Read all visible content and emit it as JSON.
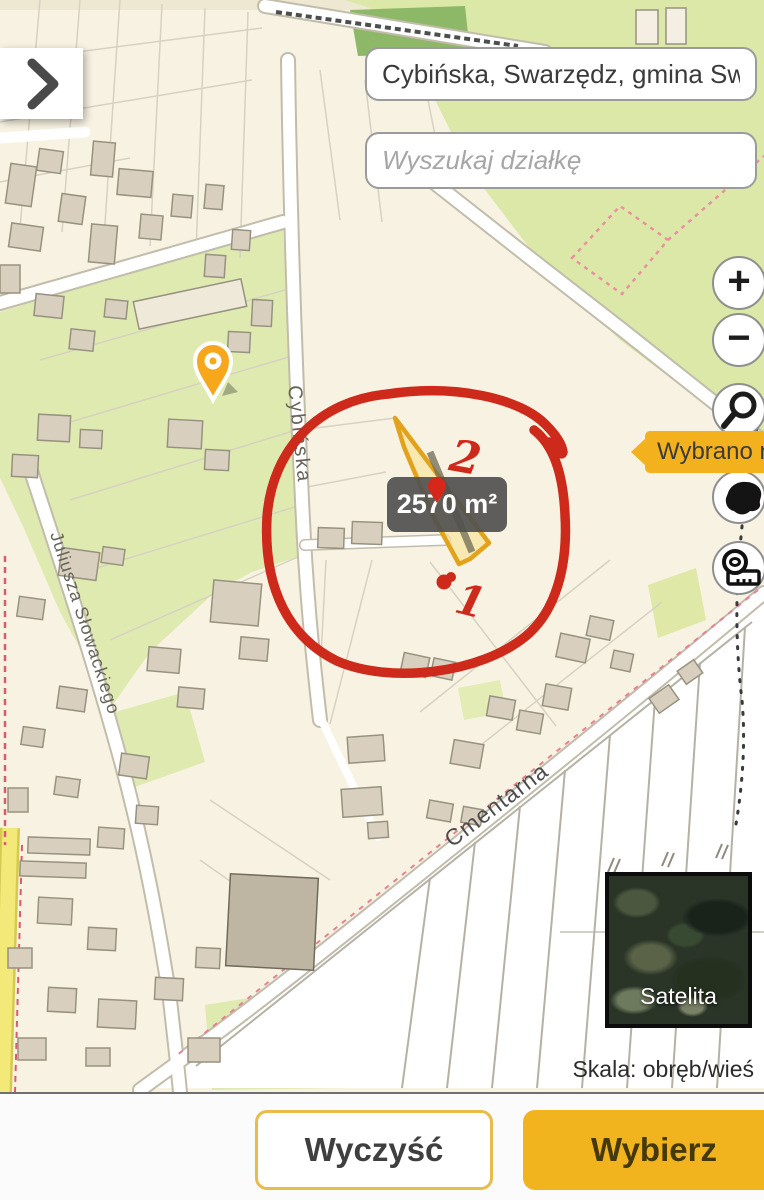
{
  "search": {
    "location_value": "Cybińska, Swarzędz, gmina Swa",
    "parcel_placeholder": "Wyszukaj działkę"
  },
  "controls": {
    "zoom_in": "+",
    "zoom_out": "−",
    "search_tool_icon": "magnifier-icon",
    "region_tool_icon": "poland-outline-icon",
    "measure_tool_icon": "tape-measure-icon"
  },
  "notification": {
    "text": "Wybrano ni"
  },
  "map": {
    "area_tooltip": "2570 m²",
    "streets": {
      "cybinska": "Cybińska",
      "slowackiego": "Juliusza Słowackiego",
      "cmentarna": "Cmentarna"
    },
    "annotations": {
      "one": "1",
      "two": "2"
    }
  },
  "layers": {
    "satellite_label": "Satelita"
  },
  "scale": {
    "label": "Skala: obręb/wieś"
  },
  "footer": {
    "clear": "Wyczyść",
    "select": "Wybierz"
  },
  "colors": {
    "accent_yellow": "#F2B21D",
    "annotation_red": "#CE2A1B",
    "parcel_stroke": "#E2A21C",
    "map_green": "#DCE8A8",
    "map_cream": "#F8F2E2"
  }
}
